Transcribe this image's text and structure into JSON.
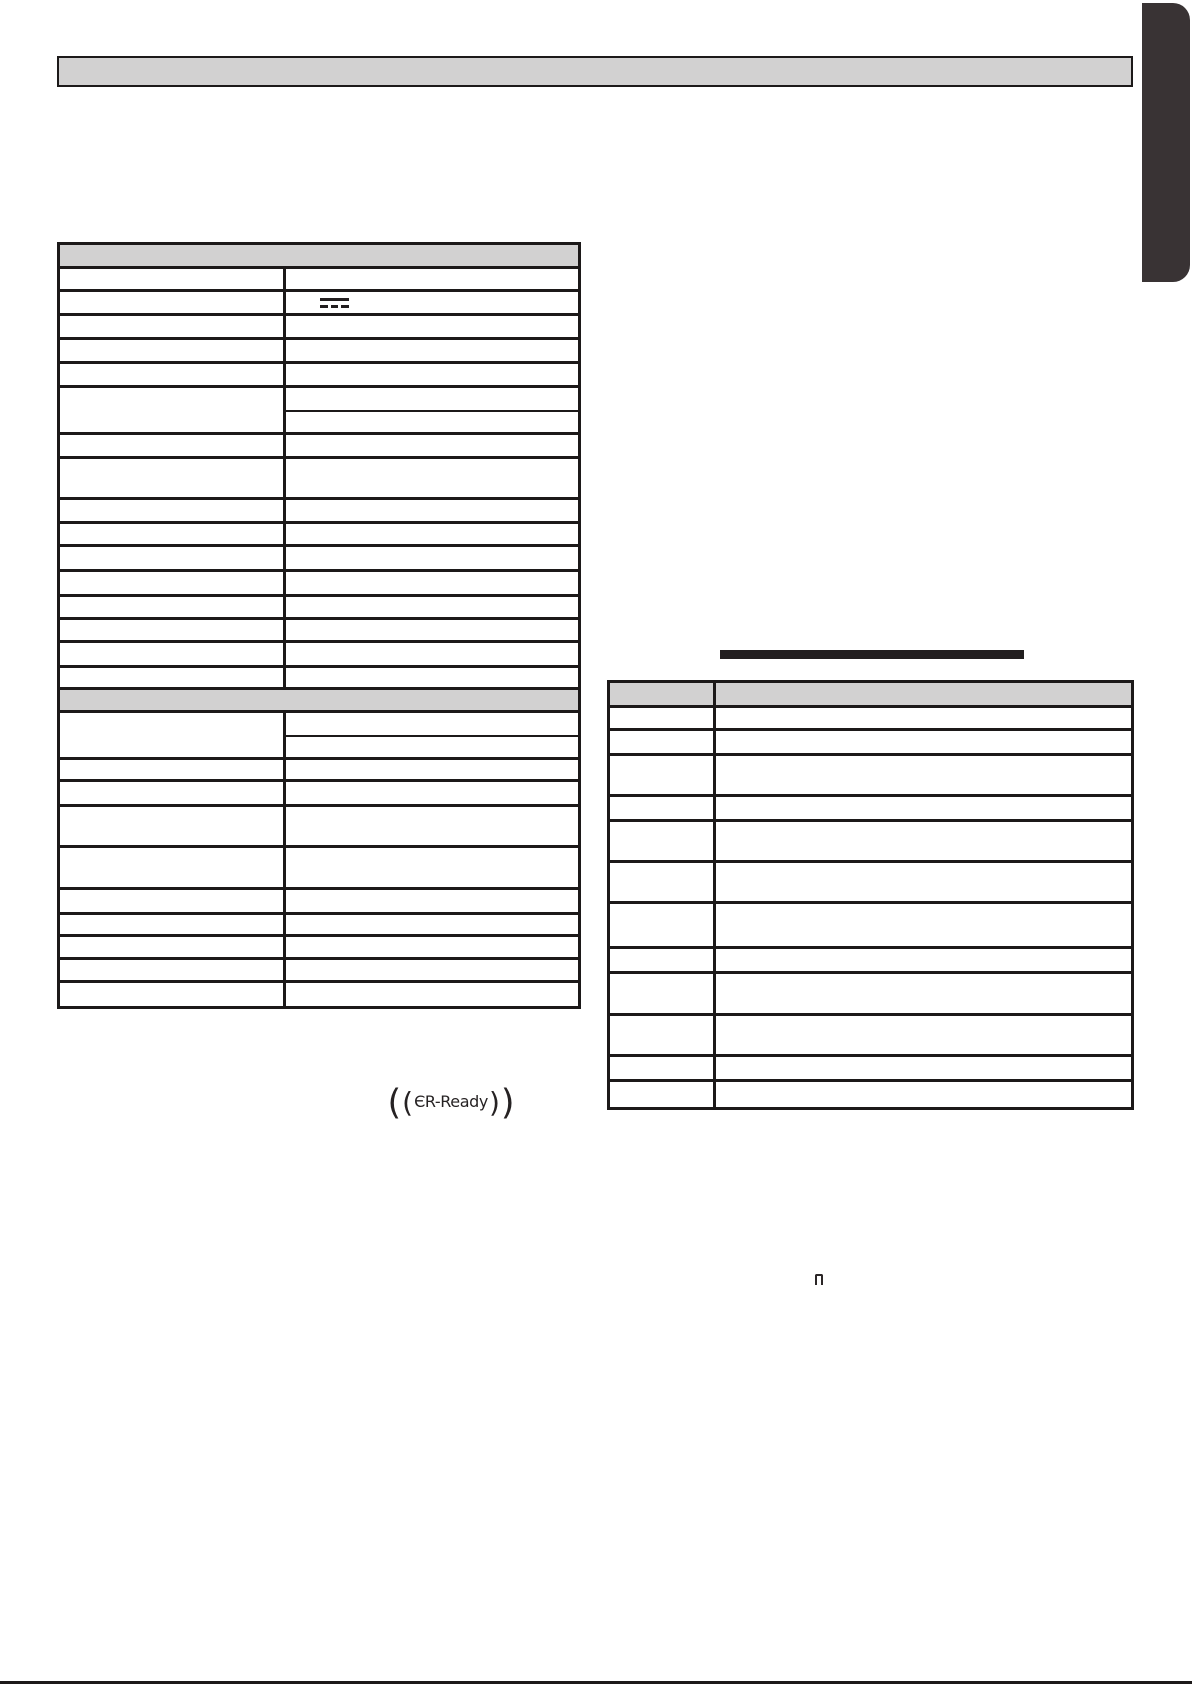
{
  "colors": {
    "ink": "#1c1919",
    "header_fill": "#d2d1d1",
    "tab_fill": "#393334",
    "accent_bar": "#221e1f",
    "page_bg": "#ffffff"
  },
  "top_banner": {
    "text": ""
  },
  "left_table": {
    "rows": [
      {
        "kind": "section",
        "h": 24
      },
      {
        "kind": "row",
        "h": 23
      },
      {
        "kind": "row",
        "h": 24,
        "icon": "dc-current"
      },
      {
        "kind": "row",
        "h": 24
      },
      {
        "kind": "row",
        "h": 24
      },
      {
        "kind": "row",
        "h": 24
      },
      {
        "kind": "split",
        "h": 47,
        "split": 24
      },
      {
        "kind": "row",
        "h": 24
      },
      {
        "kind": "row",
        "h": 41
      },
      {
        "kind": "row",
        "h": 24
      },
      {
        "kind": "row",
        "h": 23
      },
      {
        "kind": "row",
        "h": 25
      },
      {
        "kind": "row",
        "h": 25
      },
      {
        "kind": "row",
        "h": 23
      },
      {
        "kind": "row",
        "h": 23
      },
      {
        "kind": "row",
        "h": 25
      },
      {
        "kind": "row",
        "h": 22
      },
      {
        "kind": "section",
        "h": 23
      },
      {
        "kind": "split",
        "h": 47,
        "split": 24
      },
      {
        "kind": "row",
        "h": 22
      },
      {
        "kind": "row",
        "h": 25
      },
      {
        "kind": "row",
        "h": 41
      },
      {
        "kind": "row",
        "h": 42
      },
      {
        "kind": "row",
        "h": 25
      },
      {
        "kind": "row",
        "h": 22
      },
      {
        "kind": "row",
        "h": 23
      },
      {
        "kind": "row",
        "h": 23
      },
      {
        "kind": "row",
        "h": 23
      }
    ]
  },
  "right_table": {
    "rows": [
      {
        "kind": "header",
        "h": 25
      },
      {
        "kind": "row",
        "h": 23
      },
      {
        "kind": "row",
        "h": 25
      },
      {
        "kind": "row",
        "h": 41
      },
      {
        "kind": "row",
        "h": 25
      },
      {
        "kind": "row",
        "h": 41
      },
      {
        "kind": "row",
        "h": 41
      },
      {
        "kind": "row",
        "h": 45
      },
      {
        "kind": "row",
        "h": 25
      },
      {
        "kind": "row",
        "h": 42
      },
      {
        "kind": "row",
        "h": 41
      },
      {
        "kind": "row",
        "h": 25
      },
      {
        "kind": "row",
        "h": 25
      }
    ]
  },
  "er_ready_logo": {
    "outer_open": "(",
    "inner_open": "(",
    "text": "ЄR-Ready",
    "inner_close": ")",
    "outer_close": ")"
  },
  "seven_segment_glyph": {
    "display_char": "n"
  },
  "dc_symbol": {
    "icon": "dc-current"
  }
}
